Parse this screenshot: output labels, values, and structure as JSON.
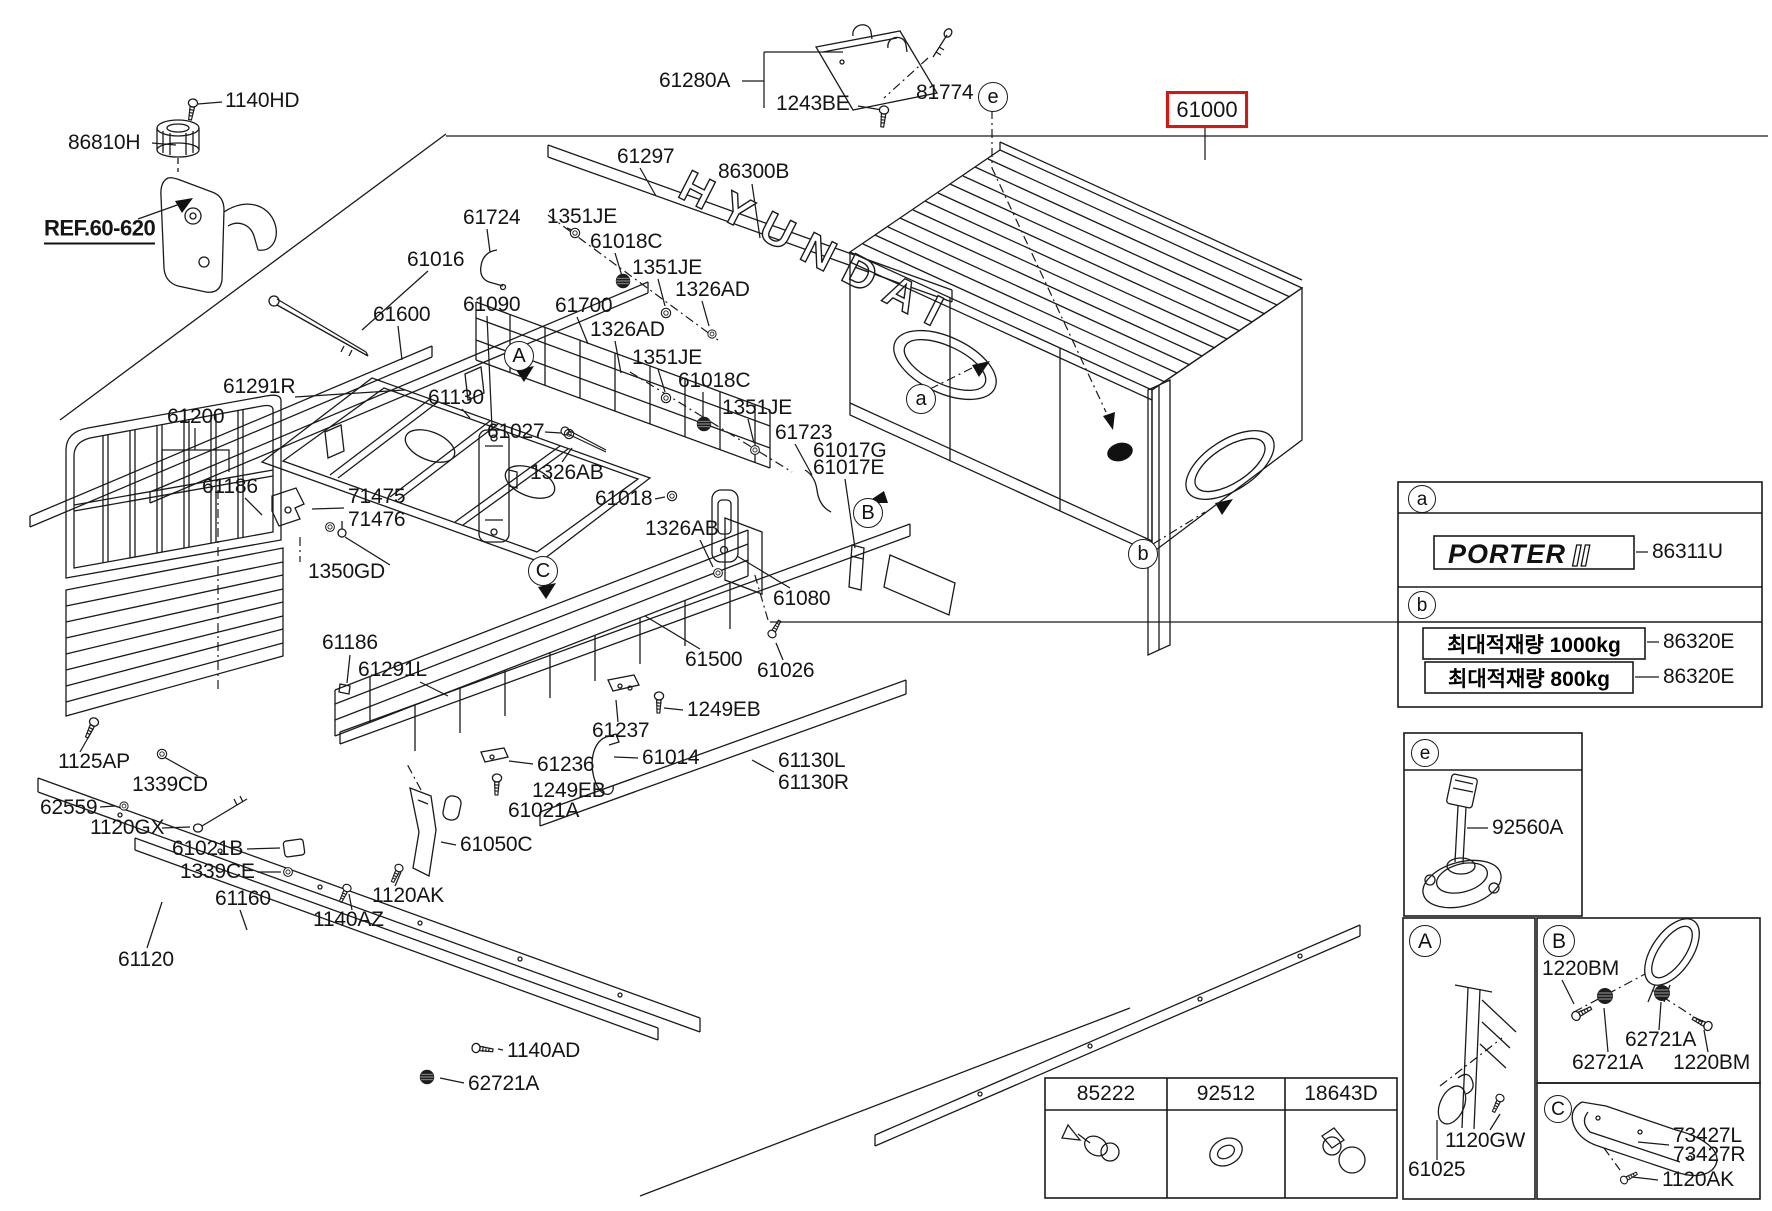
{
  "palette": {
    "line": "#1a1a1a",
    "highlight_red": "#e8100c",
    "background": "#ffffff"
  },
  "highlight": {
    "text": "61000"
  },
  "ref": {
    "text": "REF.60-620"
  },
  "logo": {
    "hyundai": "HYUNDAI",
    "porter": "PORTER",
    "roman": "II"
  },
  "legend": {
    "section_a_code": "86311U",
    "plates": [
      {
        "text": "최대적재량 1000kg",
        "code": "86320E"
      },
      {
        "text": "최대적재량 800kg",
        "code": "86320E"
      }
    ]
  },
  "fastener_table": {
    "columns": [
      "85222",
      "92512",
      "18643D"
    ]
  },
  "callouts": [
    {
      "ch": "e",
      "x": 992,
      "y": 96,
      "r": 14,
      "fs": 20
    },
    {
      "ch": "a",
      "x": 920,
      "y": 398,
      "r": 14,
      "fs": 20
    },
    {
      "ch": "b",
      "x": 1142,
      "y": 553,
      "r": 14,
      "fs": 20
    },
    {
      "ch": "A",
      "x": 518,
      "y": 355,
      "r": 14,
      "fs": 20
    },
    {
      "ch": "B",
      "x": 867,
      "y": 512,
      "r": 14,
      "fs": 20
    },
    {
      "ch": "C",
      "x": 542,
      "y": 570,
      "r": 14,
      "fs": 20
    },
    {
      "ch": "a",
      "x": 1421,
      "y": 498,
      "r": 13,
      "fs": 19
    },
    {
      "ch": "b",
      "x": 1421,
      "y": 604,
      "r": 13,
      "fs": 19
    },
    {
      "ch": "e",
      "x": 1424,
      "y": 752,
      "r": 13,
      "fs": 19
    },
    {
      "ch": "A",
      "x": 1424,
      "y": 940,
      "r": 15,
      "fs": 21
    },
    {
      "ch": "B",
      "x": 1558,
      "y": 940,
      "r": 15,
      "fs": 21
    },
    {
      "ch": "C",
      "x": 1557,
      "y": 1108,
      "r": 13,
      "fs": 19
    }
  ],
  "part_labels": [
    {
      "text": "1140HD",
      "x": 225,
      "y": 101
    },
    {
      "text": "86810H",
      "x": 68,
      "y": 143
    },
    {
      "text": "61280A",
      "x": 659,
      "y": 81
    },
    {
      "text": "1243BE",
      "x": 776,
      "y": 104
    },
    {
      "text": "81774",
      "x": 916,
      "y": 93
    },
    {
      "text": "61297",
      "x": 617,
      "y": 157
    },
    {
      "text": "86300B",
      "x": 718,
      "y": 172
    },
    {
      "text": "61724",
      "x": 463,
      "y": 218
    },
    {
      "text": "1351JE",
      "x": 547,
      "y": 217
    },
    {
      "text": "61018C",
      "x": 590,
      "y": 242
    },
    {
      "text": "61016",
      "x": 407,
      "y": 260
    },
    {
      "text": "1351JE",
      "x": 632,
      "y": 268
    },
    {
      "text": "1326AD",
      "x": 675,
      "y": 290
    },
    {
      "text": "61090",
      "x": 463,
      "y": 305
    },
    {
      "text": "61700",
      "x": 555,
      "y": 306
    },
    {
      "text": "61600",
      "x": 373,
      "y": 315
    },
    {
      "text": "1326AD",
      "x": 590,
      "y": 330
    },
    {
      "text": "1351JE",
      "x": 632,
      "y": 358
    },
    {
      "text": "61018C",
      "x": 678,
      "y": 381
    },
    {
      "text": "61291R",
      "x": 223,
      "y": 387
    },
    {
      "text": "61130",
      "x": 428,
      "y": 398
    },
    {
      "text": "1351JE",
      "x": 722,
      "y": 408
    },
    {
      "text": "61200",
      "x": 167,
      "y": 417
    },
    {
      "text": "61027",
      "x": 487,
      "y": 432
    },
    {
      "text": "61723",
      "x": 775,
      "y": 433
    },
    {
      "text": "61017G",
      "x": 813,
      "y": 451
    },
    {
      "text": "61017E",
      "x": 813,
      "y": 468
    },
    {
      "text": "1326AB",
      "x": 530,
      "y": 473
    },
    {
      "text": "61186",
      "x": 202,
      "y": 487
    },
    {
      "text": "71475",
      "x": 348,
      "y": 497
    },
    {
      "text": "71476",
      "x": 348,
      "y": 520
    },
    {
      "text": "61018",
      "x": 595,
      "y": 499
    },
    {
      "text": "1326AB",
      "x": 645,
      "y": 529
    },
    {
      "text": "1350GD",
      "x": 308,
      "y": 572
    },
    {
      "text": "61080",
      "x": 773,
      "y": 599
    },
    {
      "text": "61186",
      "x": 322,
      "y": 643
    },
    {
      "text": "61291L",
      "x": 358,
      "y": 670
    },
    {
      "text": "61500",
      "x": 685,
      "y": 660
    },
    {
      "text": "61026",
      "x": 757,
      "y": 671
    },
    {
      "text": "1249EB",
      "x": 687,
      "y": 710
    },
    {
      "text": "61237",
      "x": 592,
      "y": 731
    },
    {
      "text": "1125AP",
      "x": 58,
      "y": 762
    },
    {
      "text": "61236",
      "x": 537,
      "y": 765
    },
    {
      "text": "61014",
      "x": 642,
      "y": 758
    },
    {
      "text": "61130L",
      "x": 778,
      "y": 761
    },
    {
      "text": "61130R",
      "x": 778,
      "y": 783
    },
    {
      "text": "1339CD",
      "x": 132,
      "y": 785
    },
    {
      "text": "1249EB",
      "x": 532,
      "y": 791
    },
    {
      "text": "62559",
      "x": 40,
      "y": 808
    },
    {
      "text": "61021A",
      "x": 508,
      "y": 811
    },
    {
      "text": "1120GX",
      "x": 90,
      "y": 828
    },
    {
      "text": "61021B",
      "x": 172,
      "y": 849
    },
    {
      "text": "61050C",
      "x": 460,
      "y": 845
    },
    {
      "text": "1339CE",
      "x": 180,
      "y": 872
    },
    {
      "text": "1120AK",
      "x": 372,
      "y": 896
    },
    {
      "text": "61160",
      "x": 215,
      "y": 899
    },
    {
      "text": "1140AZ",
      "x": 313,
      "y": 920
    },
    {
      "text": "61120",
      "x": 118,
      "y": 960
    },
    {
      "text": "1140AD",
      "x": 507,
      "y": 1051
    },
    {
      "text": "62721A",
      "x": 468,
      "y": 1084
    },
    {
      "text": "86311U",
      "x": 1652,
      "y": 552
    },
    {
      "text": "86320E",
      "x": 1663,
      "y": 642
    },
    {
      "text": "86320E",
      "x": 1663,
      "y": 677
    },
    {
      "text": "92560A",
      "x": 1492,
      "y": 828
    },
    {
      "text": "1120GW",
      "x": 1445,
      "y": 1141
    },
    {
      "text": "61025",
      "x": 1408,
      "y": 1170
    },
    {
      "text": "1220BM",
      "x": 1542,
      "y": 969
    },
    {
      "text": "62721A",
      "x": 1625,
      "y": 1040
    },
    {
      "text": "62721A",
      "x": 1572,
      "y": 1063
    },
    {
      "text": "1220BM",
      "x": 1673,
      "y": 1063
    },
    {
      "text": "73427L",
      "x": 1673,
      "y": 1136
    },
    {
      "text": "73427R",
      "x": 1673,
      "y": 1155
    },
    {
      "text": "1120AK",
      "x": 1662,
      "y": 1180
    }
  ]
}
